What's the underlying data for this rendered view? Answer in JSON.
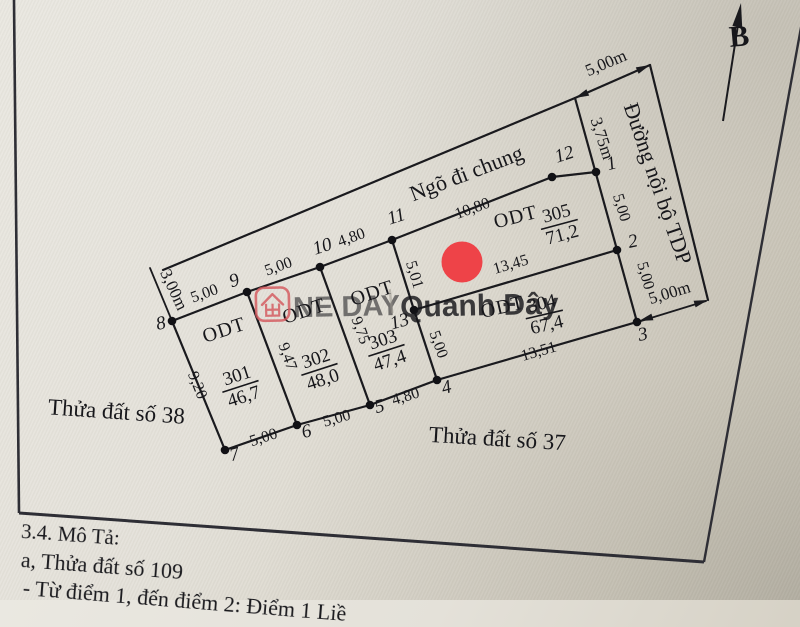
{
  "colors": {
    "line": "#1a1a1e",
    "marker_red": "#ee4348",
    "watermark_red": "#e0555a",
    "watermark_gray": "#a09c93"
  },
  "compass": {
    "north_label": "B"
  },
  "watermark": {
    "icon": "house-icon",
    "left": "NE DAY",
    "divider": "|",
    "right": "Quanh Đây"
  },
  "map": {
    "alley_label": "Ngõ đi chung",
    "road_label": "Đường nội bộ TDP",
    "adjacent_parcel_left": "Thửa đất số 38",
    "adjacent_parcel_bottom": "Thửa đất số 37",
    "points": {
      "p1": "1",
      "p2": "2",
      "p3": "3",
      "p4": "4",
      "p5": "5",
      "p6": "6",
      "p7": "7",
      "p8": "8",
      "p9": "9",
      "p10": "10",
      "p11": "11",
      "p12": "12",
      "p13": "13"
    },
    "parcels": {
      "p301": {
        "use": "ODT",
        "no": "301",
        "area": "46,7"
      },
      "p302": {
        "use": "ODT",
        "no": "302",
        "area": "48,0"
      },
      "p303": {
        "use": "ODT",
        "no": "303",
        "area": "47,4"
      },
      "p304": {
        "use": "ODT",
        "no": "304",
        "area": "67,4"
      },
      "p305": {
        "use": "ODT",
        "no": "305",
        "area": "71,2"
      }
    },
    "dims": {
      "alley_west": "3,00m",
      "seg_8_9": "5,00",
      "seg_9_10": "5,00",
      "seg_10_11": "4,80",
      "seg_11_12": "10,80",
      "seg_8_7": "9,20",
      "seg_9_6": "9,47",
      "seg_10_5": "9,75",
      "seg_11_13": "5,01",
      "seg_13_4": "5,00",
      "seg_13_2": "13,45",
      "seg_7_6": "5,00",
      "seg_6_5": "5,00",
      "seg_5_4": "4,80",
      "seg_4_3": "13,51",
      "seg_1_2": "5,00",
      "seg_2_3": "5,00",
      "road_width_top": "5,00m",
      "road_width_bottom": "5,00m",
      "corner_to_1": "3,75m"
    }
  },
  "description": {
    "heading": "3.4. Mô Tả:",
    "line_a": "a, Thửa đất số 109",
    "line_b": "- Từ điểm 1, đến điểm 2: Điểm 1 Liề"
  }
}
